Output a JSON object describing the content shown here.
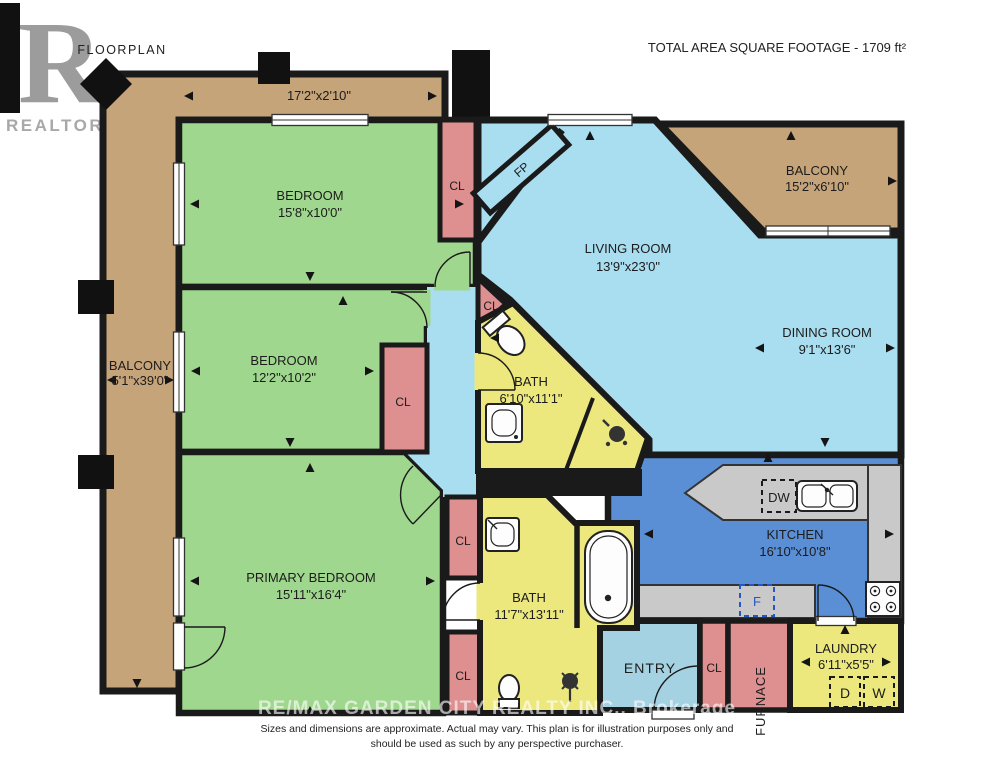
{
  "header": {
    "floorplan": "FLOORPLAN",
    "total_area": "TOTAL AREA SQUARE FOOTAGE - 1709 ft²"
  },
  "logo": {
    "r": "R",
    "realtor": "REALTOR®"
  },
  "rooms": {
    "balcony_top": {
      "dims": "17'2\"x2'10\""
    },
    "balcony_left": {
      "name": "BALCONY",
      "dims": "5'1\"x39'0\""
    },
    "balcony_right": {
      "name": "BALCONY",
      "dims": "15'2\"x6'10\""
    },
    "bedroom1": {
      "name": "BEDROOM",
      "dims": "15'8\"x10'0\""
    },
    "bedroom2": {
      "name": "BEDROOM",
      "dims": "12'2\"x10'2\""
    },
    "primary_bedroom": {
      "name": "PRIMARY BEDROOM",
      "dims": "15'11\"x16'4\""
    },
    "living_room": {
      "name": "LIVING ROOM",
      "dims": "13'9\"x23'0\""
    },
    "dining_room": {
      "name": "DINING ROOM",
      "dims": "9'1\"x13'6\""
    },
    "kitchen": {
      "name": "KITCHEN",
      "dims": "16'10\"x10'8\""
    },
    "bath_upper": {
      "name": "BATH",
      "dims": "6'10\"x11'1\""
    },
    "bath_lower": {
      "name": "BATH",
      "dims": "11'7\"x13'11\""
    },
    "laundry": {
      "name": "LAUNDRY",
      "dims": "6'11\"x5'5\""
    },
    "entry": {
      "name": "ENTRY"
    },
    "furnace": {
      "name": "FURNACE"
    }
  },
  "fixtures": {
    "closet": "CL",
    "fireplace": "FP",
    "dishwasher": "DW",
    "fridge": "F",
    "dryer": "D",
    "washer": "W"
  },
  "watermark": "RE/MAX GARDEN CITY REALTY INC., Brokerage",
  "disclaimer": {
    "line1": "Sizes and dimensions are approximate. Actual may vary. This plan is for illustration purposes only and",
    "line2": "should be used as such by any perspective purchaser."
  },
  "colors": {
    "balcony_tan": "#c5a47a",
    "bedroom_green": "#a0d78e",
    "living_blue": "#a9def1",
    "kitchen_blue": "#5a8fd6",
    "entry_blue": "#a5d2e2",
    "bath_yellow": "#ece87d",
    "closet_pink": "#de8f8f",
    "counter_gray": "#c9c9c9",
    "wall_black": "#1a1a1a"
  }
}
